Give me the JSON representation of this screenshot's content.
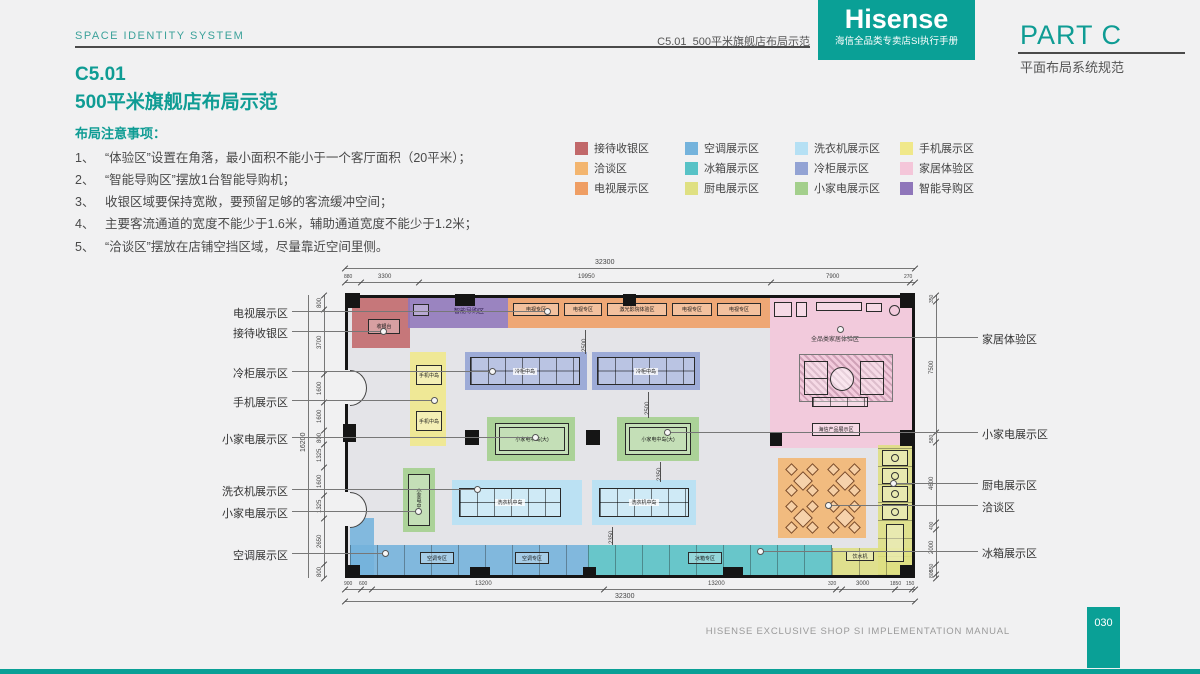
{
  "header": {
    "system_label": "SPACE IDENTITY SYSTEM",
    "breadcrumb": "C5.01  500平米旗舰店布局示范",
    "brand": {
      "logo": "Hisense",
      "tagline": "海信全品类专卖店SI执行手册"
    },
    "part_title": "PART C",
    "part_subtitle": "平面布局系统规范"
  },
  "title": {
    "code": "C5.01",
    "name": "500平米旗舰店布局示范"
  },
  "notes": {
    "heading": "布局注意事项：",
    "items": [
      {
        "num": "1、",
        "text": "“体验区”设置在角落，最小面积不能小于一个客厅面积（20平米）；"
      },
      {
        "num": "2、",
        "text": "“智能导购区”摆放1台智能导购机；"
      },
      {
        "num": "3、",
        "text": "收银区域要保持宽敞，要预留足够的客流缓冲空间；"
      },
      {
        "num": "4、",
        "text": "主要客流通道的宽度不能少于1.6米，辅助通道宽度不能少于1.2米；"
      },
      {
        "num": "5、",
        "text": "“洽谈区”摆放在店铺空挡区域，尽量靠近空间里侧。"
      }
    ]
  },
  "legend": {
    "items": [
      {
        "label": "接待收银区",
        "color": "#c1686a"
      },
      {
        "label": "空调展示区",
        "color": "#74b3dc"
      },
      {
        "label": "洗衣机展示区",
        "color": "#b5e0f4"
      },
      {
        "label": "手机展示区",
        "color": "#f0e88a"
      },
      {
        "label": "洽谈区",
        "color": "#f3b56f"
      },
      {
        "label": "冰箱展示区",
        "color": "#57c2c6"
      },
      {
        "label": "冷柜展示区",
        "color": "#93a3d4"
      },
      {
        "label": "家居体验区",
        "color": "#f4c6d9"
      },
      {
        "label": "电视展示区",
        "color": "#ef9e64"
      },
      {
        "label": "厨电展示区",
        "color": "#dfe082"
      },
      {
        "label": "小家电展示区",
        "color": "#a3cf8c"
      },
      {
        "label": "智能导购区",
        "color": "#8f76ba"
      }
    ]
  },
  "plan": {
    "interior": {
      "cashier": "收银台",
      "smart_guide": "智能导购区",
      "tv_zone": "电视专区",
      "tv_exp": "激光影院体验区",
      "home_exp": "全品类家居体验区",
      "product_display": "海信产品展示区",
      "freezer_island": "冷柜中岛",
      "phone_island": "手机中岛",
      "sa_island_large": "小家电中岛(大)",
      "sa_island": "小家电中岛",
      "washer_island": "洗衣机中岛",
      "ac_zone": "空调专区",
      "fridge_zone": "冰箱专区",
      "water": "饮水机"
    },
    "left_labels": [
      "电视展示区",
      "接待收银区",
      "冷柜展示区",
      "手机展示区",
      "小家电展示区",
      "洗衣机展示区",
      "小家电展示区",
      "空调展示区"
    ],
    "right_labels": [
      "家居体验区",
      "小家电展示区",
      "厨电展示区",
      "洽谈区",
      "冰箱展示区"
    ],
    "dims": {
      "total": "32300",
      "top": [
        "880",
        "3300",
        "19950",
        "7900",
        "270"
      ],
      "bottom": [
        "900",
        "600",
        "13200",
        "13200",
        "320",
        "3000",
        "1850",
        "150"
      ],
      "left": [
        "800",
        "3700",
        "1600",
        "1600",
        "800",
        "1325",
        "1600",
        "1325",
        "2650",
        "800"
      ],
      "left_total": "16200",
      "right": [
        "350",
        "7500",
        "580",
        "4600",
        "400",
        "2000",
        "550",
        "800"
      ],
      "inner_a": "2500",
      "inner_b": "2500",
      "inner_c": "2350",
      "inner_d": "2350"
    }
  },
  "footer": {
    "manual": "HISENSE EXCLUSIVE SHOP SI IMPLEMENTATION MANUAL",
    "page": "030"
  }
}
